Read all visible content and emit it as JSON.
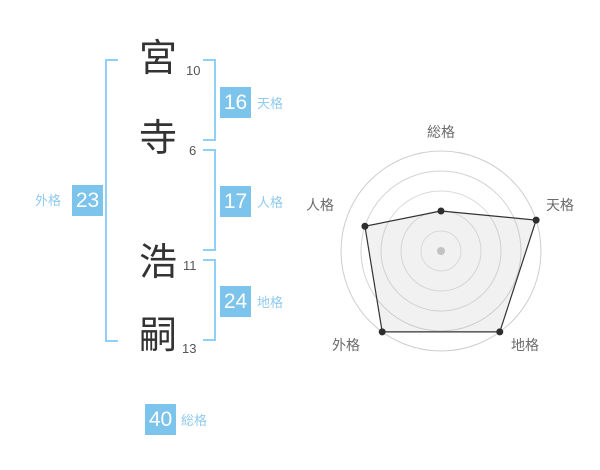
{
  "name": {
    "family": [
      {
        "char": "宮",
        "strokes": "10"
      },
      {
        "char": "寺",
        "strokes": "6"
      }
    ],
    "given": [
      {
        "char": "浩",
        "strokes": "11"
      },
      {
        "char": "嗣",
        "strokes": "13"
      }
    ]
  },
  "kaku": {
    "tenkaku": {
      "label": "天格",
      "value": "16"
    },
    "jinkaku": {
      "label": "人格",
      "value": "17"
    },
    "chikaku": {
      "label": "地格",
      "value": "24"
    },
    "gaikaku": {
      "label": "外格",
      "value": "23"
    },
    "soukaku": {
      "label": "総格",
      "value": "40"
    }
  },
  "chart_data": {
    "type": "radar",
    "axes": [
      "総格",
      "天格",
      "地格",
      "外格",
      "人格"
    ],
    "values": [
      2,
      5,
      5,
      5,
      4
    ],
    "max": 5,
    "rings": 5,
    "grid": "concentric-circles",
    "legend": false,
    "title": ""
  },
  "colors": {
    "accent_blue": "#7cc4ec",
    "label_blue": "#90cbee",
    "bracket_blue": "#8fd0f6",
    "kanji_color": "#333333",
    "stroke_number_color": "#555555",
    "chart_grid": "#d6d6d6",
    "chart_line": "#333333",
    "chart_dot": "#2e2e2e",
    "chart_center_dot": "#c8c8c8",
    "chart_fill": "rgba(170,170,170,0.16)",
    "chart_label": "#6b6b6b"
  }
}
